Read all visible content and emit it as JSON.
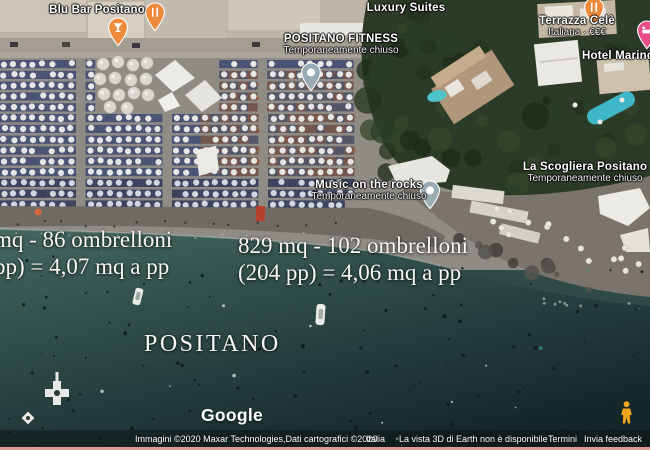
{
  "labels": {
    "blu_bar": {
      "name": "Blu Bar Positano"
    },
    "luxury_suites": {
      "name": "Luxury Suites"
    },
    "positano_fitness": {
      "name": "POSITANO FITNESS",
      "status": "Temporaneamente chiuso"
    },
    "terrazza_cele": {
      "name": "Terrazza Celè",
      "info": "Italiana · €€€"
    },
    "hotel_marinca": {
      "name": "Hotel Marinca"
    },
    "la_scogliera": {
      "name": "La Scogliera Positano",
      "status": "Temporaneamente chiuso"
    },
    "music_on_the_rocks": {
      "name": "Music on the rocks",
      "status": "Temporaneamente chiuso"
    }
  },
  "overlay": {
    "left_measurement": {
      "line1": "mq - 86 ombrelloni",
      "line2": "pp) = 4,07 mq a pp"
    },
    "center_measurement": {
      "line1": "829 mq - 102 ombrelloni",
      "line2": "(204 pp) = 4,06 mq a pp"
    },
    "place_name": "POSITANO"
  },
  "footer": {
    "logo": "Google",
    "attribution": "Immagini ©2020 Maxar Technologies,Dati cartografici ©2020",
    "region": "Italia",
    "notice": "La vista 3D di Earth non è disponibile",
    "terms_link": "Termini",
    "feedback_link": "Invia feedback"
  },
  "icons": {
    "pins": [
      "cocktail-pin",
      "restaurant-pin",
      "restaurant-pin",
      "hotel-pin",
      "closed-place-pin",
      "closed-place-pin"
    ],
    "pegman": "street-view-pegman"
  },
  "colors": {
    "water_deep": "#1b2d2e",
    "water_shallow": "#466760",
    "sand": "#8f8b85",
    "vegetation": "#2b3b27",
    "umbrella_shadow_navy": "#3a4770",
    "umbrella_shadow_red": "#6e4c42",
    "pin_orange": "#EE8A3C",
    "pin_pink": "#EA4E89",
    "pin_gray": "#9AACB3",
    "pool": "#45BECC",
    "pegman_yellow": "#F2A61C",
    "bottom_line": "#DF9B92"
  }
}
